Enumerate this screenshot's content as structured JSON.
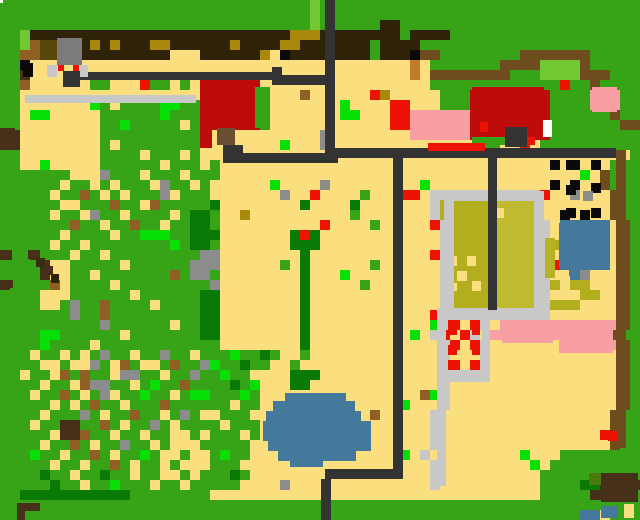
{
  "map": {
    "width": 640,
    "height": 520,
    "tile_size": 10,
    "palette": {
      "G": "#36a416",
      "g": "#07e007",
      "d": "#0a7a07",
      "w": "#72c832",
      "Y": "#fbdf7e",
      "B": "#2e2306",
      "h": "#a8890b",
      "m": "#574708",
      "b": "#8f5f23",
      "u": "#46301a",
      "n": "#6f4c1d",
      "C": "#c07c2a",
      "R": "#ee1205",
      "r": "#be0c0a",
      "K": "#f79fa2",
      "W": "#ffffff",
      "L": "#c8c8c8",
      "A": "#8c8c8c",
      "D": "#333333",
      "k": "#0a0a0a",
      "U": "#45799b",
      "O": "#b2ae1e",
      "o": "#c0ba30"
    },
    "palette_names": {
      "G": "grass",
      "g": "bright-bush",
      "d": "dark-tree",
      "w": "light-grass",
      "Y": "sand",
      "B": "dark-soil",
      "h": "soil-accent",
      "m": "olive-soil",
      "b": "dirt",
      "u": "dark-wood",
      "n": "brown-fence",
      "C": "orange-crate",
      "R": "red-marker",
      "r": "red-roof",
      "K": "pink-blossom",
      "W": "white",
      "L": "gray-road",
      "A": "gray-rock",
      "D": "dark-path",
      "k": "black-hole",
      "U": "water",
      "O": "crop-field",
      "o": "crop-field-light"
    },
    "grid": [
      "GGGGGGGGGGGGGGGGGGGGGGGGGGGGGGGwGGGGGGGGGGGGGGGGGGGGGGGGGGGGGGGG",
      "GGGGGGGGGGGGGGGGGGGGGGGGGGGGGGGwGGGGGGGGGGGGGGGGGGGGGGGGGGGGGGGG",
      "GGGGGGGGGGGGGGGGGGGGGGGGGGGGGGGwGGGGGGBBGGGGGGGGGGGGGGGGGGGGGGGG",
      "GGwBBBBBBBBBBBBBBBBBBBBBBBBBBhhhBBBBBBBBGBBBBGGGGGGGGGGGGGGGGGGGG",
      "GGwbmmBBBhBhBBBhhBBBBBBhBBBBhhBBBBBBBGBBBBGGGGGGGGGGGGGGGGGGGGGG",
      "GGbbmmBBBBBBBBBBBYYYBBBBBBhYkBBBBBBBBGBBBknnGGGGGGGGnnnnnnnGGGGG",
      "GGkYYYYYYYYYYYYYYYYYYYYYYYYYYYYYYYYYYYYYYCYGGGGGGGnnnnwwwwnGGGG",
      "GGuYYYYYYYYYYYYYYYYYYYYYYYYYYYYYYYYYYYYYYCYnnnnnnnnGGGwwwwnnnGG",
      "GGbYYYYYYGGYYYRGGYGYrrrrrrYYYYYYYYYYYYYYYYYGGGGGGGGGGGGGRGGnGG",
      "GGYYYYYYYYYYYYYYYYYYrrrrrrGYYYbYYYYYYRhYYYYYGGGrrrrrrrrGGGGKKKGG",
      "GGYYYYYYYgGYGGGGggGGrrrrrrGYYYYYYYgYYYYRRYYYGGGrrrrrrrrGGGGKKKGG",
      "GGYggYYYYYGGGGGGgGGGrrrrrrGYYYYYYYggYYYRRKKKKKKrrrrrrrrGGGGGGnGG",
      "GGYYYYYYYYGGgGGGGGYGrrrrrrGYYYYYYYYYYYYRRKKKKKKrrrrrrrrGGGGGGGnn",
      "uuYYYYYYYYGGGGGGGGGGYYYYYYYYYYYYAYYYYYYYYKKKKKKrrrrYYrrGGGGGGGGG",
      "uuYYYYYYYYGYGGGGGGGGYYYYYYYYgYYYAYYYYYYYYYYYYYYYGGYYRYGGGGGGGGG",
      "GGYYYYYYYYGGGGYGGGYGYYYYYYYYYYYYYYYYYYYYYYYYYYYYYYYYYYYYYYYYYYY",
      "GGYYgYYYYYGGGGGGYGGGYGYYYYYYYYYYYYYYYYYYYYYYYYYYYYYYYYYkYkYYYG",
      "GGGGGGGYYYAGGGYGGGYGGGYYYYYYYYYYYYYYYYYYYYYYYYYYYYYYYYYYYYgYnG",
      "GGGGGGYGGYGYGGGYAGGYGYYYYYYgYYYYAYYYYYYYYYgYYYYYYYYYYYYkYkYYnG",
      "GGGGGYGGbGYGYGGGAYGGGYYYYYYYAYYRYYYYGYYYRRYLLLLLLLLLLLRYYAYYYnG",
      "GGGGGGYYGGGbGGYbGGGGGdYYYYYYYYdYYYYdYYYYYYYLOOOOYooooLYYYYYYYnG",
      "GGGGGYGGYAGGYGGGGYGddGYYhYYYYYYYYYYGYYYYYYYLOOOOYYoooLYYkYkYYnG",
      "GGGGGGGbGGYGGbGGYGGddGYYYYYYYYYYRYYYYGYYYYYRLOOOOYooooLYUUUUUYnG",
      "GGGGGGYGGGGYGGgggGGdddYYYYYYYdRdYYYYYYYYYYYYLOOOOYooooLYUUUUUYnG",
      "GGGGGYGGYGGGGGGGGgGddGYYYYYYYdddYYYYYYYYYYYYLOOOOYooooLOUUUUUYnG",
      "uGGuGGGYGGYGGGGGGGGGAAYYYYYYYYdYYYYYYYYYYYYRLOOOOYooooLYUUUUUYnG",
      "GGGGuYYGGGGGYGGGGGGAAAYYYYYYGYdYYYYYYGYYYYYYLYOYOYooooLRUUUUUYnG",
      "GGGGuYYGGYGGGGGGGbGAAGYYYYYYYYdYYYgYYYYYYYYYLOYOOYooooLYYUAYYYnG",
      "uGGGGbYGGGGYGGGGGGGGGAYYYYYYYYdYYYYYGYYYYYYYLYOYOYooooLOYOOYYYnG",
      "GGGGYYYGGGGGGYGGGGGGddYYYYYYYYdYYYYYYYYYYYYYLOYOYYooooLYYYOOYYnG",
      "GGGGYYGAGGbGGGGYGGGGddYYYYYYYYdYYYYYYYYYYYYYLOOYOYooooLOOOYYYYnG",
      "GGGGGGGAGGbGGGGGGGGGddYYYYYYYYdYYYYYYYYYYYYRLLLLLLLLLLLYYYYYYYnG",
      "GGGGGGGGGGAGGGGGGYGGddYYYYYYYYdYYYYYYYYYYYYgLRYRLYKKKKKKKKKKKKnG",
      "GGGGggGGGGGGYGGGGGGGddYYYYYYYYdYYYYYYYYYYgYLRYRLYKKKKKKKKKKKKnG",
      "GGGGgGGGGYGGGGGGGGGGGGYYYYYYYYdYYYYYYYYYYYYYLRYRLYYYYYYYKKKKKKnG",
      "GGGYGGYGYGAGGYGGAGGYGGGgGGdGYYGYYYYYYYYYYYYYLYYYLYYYYYYYYYYYYYnG",
      "GGGGYYGYYAGYbGYYGbGGAgGGdGGYYGYYYYYYYYYYYYYYLRYRLYYYYYYYYYYYYYnG",
      "GGYGGYbGbGGYAAGGYGGAGGgGGYYYYdddYYYYYYYYYYYYLLLLLYYYYYYYYYYYYYnG",
      "GGGGYGGYbAAGGYGgGGbGGGGdGgYYYddYYYYYYYYYYYYYLYYYYYYYYYYYYYYYYYnG",
      "GGGYGGbGYGAYGGgGGYGggGGGgGYYYYYYYYYYYYYYYYbgLYYYYYYYYYYYYYYYYYnG",
      "GGGGGYGYGbGGYGGGbGGGGGGYGGYYYYYYYYYYYYYYgYYYLYYYYYYYYYYYYYYYYYnG",
      "GGGGYGGGAGYGGbGGYGAGYYGGGYYYYYYYYYYYYbYYYYYLYYYYYYYYYYYYYYYYYnG",
      "GGGYGGuuGGbGYGGAGYGGGGYGGGYYYYYYYYYYYYYYYYYLYYYYYYYYYYYYYYYYYnG",
      "GGGGGYuubGGYGGYGGYYGYGGGYGYYYYYYYYYYYYYYYYYLYYYYYYYYYYYYYYYYRnG",
      "GGGGYGGbGYGGAGGYGYYYGGGGGYYYYYYYYYYYYYYYYYYLYYYYYYYYYYYYYYYYYnG",
      "GGGgGGYGGbGYGGgGYYGYYGgGGYYYYYYYYYYYYYYYgYLYYYYYYYYYgYYYGGGGGG",
      "GGGGGYGGYGGbGYGGYGYYYGGGYYYYYYYYYYYYYYYYYYYLYYYYYYYYYgYGGGGGGGG",
      "GGGGdGGYGGdGGYGGYYGYGGGdGYYYYYYYYYYYYYYYYYYLYYYYYYYYYYGGGGGGGGG",
      "GGGGGdGGYGGgGGGYGGYGGGGGYYYYAYYYYYYYYYYYYYYLYYYYYYYYYYGGGGdduuuu",
      "GGdddddddddddGGGGGGGGYYYYYYYYYYYYYYYYYYYYYYYYYYYYYYYYYGGGGGuuuu",
      "GGGGGGGGGGGGGGGGGGGGGGGGGGGGGGGGGGGGGGGGGGGGGGGGGGGGGGGGGGGGGG",
      "GGGGGGGGGGGGGGGGGGGGGGGGGGGGGGGGGGGGGGGGGGGGGGGGGGGGGGGGGGUUYG"
    ],
    "features": [
      {
        "name": "crop-field-left",
        "x": 454,
        "y": 201,
        "w": 34,
        "h": 107,
        "color": "#b2ae1e"
      },
      {
        "name": "crop-field-right",
        "x": 497,
        "y": 201,
        "w": 37,
        "h": 107,
        "color": "#c0ba30"
      },
      {
        "name": "crop-field-dot-1",
        "x": 494,
        "y": 208,
        "w": 10,
        "h": 10,
        "color": "#fbdf7e"
      },
      {
        "name": "crop-field-dot-2",
        "x": 447,
        "y": 256,
        "w": 10,
        "h": 10,
        "color": "#fbdf7e"
      },
      {
        "name": "crop-field-dot-3",
        "x": 467,
        "y": 256,
        "w": 9,
        "h": 10,
        "color": "#fbdf7e"
      },
      {
        "name": "crop-field-dot-4",
        "x": 457,
        "y": 271,
        "w": 10,
        "h": 10,
        "color": "#fbdf7e"
      },
      {
        "name": "crop-field-dot-5",
        "x": 447,
        "y": 283,
        "w": 10,
        "h": 8,
        "color": "#fbdf7e"
      },
      {
        "name": "crop-field-dot-6",
        "x": 472,
        "y": 281,
        "w": 9,
        "h": 10,
        "color": "#fbdf7e"
      },
      {
        "name": "field-frame-top",
        "x": 444,
        "y": 191,
        "w": 100,
        "h": 10,
        "color": "#c8c8c8"
      },
      {
        "name": "field-frame-left",
        "x": 444,
        "y": 191,
        "w": 10,
        "h": 127,
        "color": "#c8c8c8"
      },
      {
        "name": "field-frame-right",
        "x": 534,
        "y": 191,
        "w": 10,
        "h": 127,
        "color": "#c8c8c8"
      },
      {
        "name": "field-frame-bottom",
        "x": 444,
        "y": 308,
        "w": 100,
        "h": 10,
        "color": "#c8c8c8"
      },
      {
        "name": "olive-strip-east",
        "x": 545,
        "y": 238,
        "w": 10,
        "h": 40,
        "color": "#b7b224"
      },
      {
        "name": "road-gray",
        "x": 25,
        "y": 95,
        "w": 171,
        "h": 8,
        "color": "#c8c8c8"
      },
      {
        "name": "fence-dark-long",
        "x": 80,
        "y": 72,
        "w": 193,
        "h": 8,
        "color": "#333333"
      },
      {
        "name": "fence-dark-corner",
        "x": 272,
        "y": 67,
        "w": 10,
        "h": 18,
        "color": "#333333"
      },
      {
        "name": "fence-dark-connector",
        "x": 282,
        "y": 75,
        "w": 46,
        "h": 10,
        "color": "#333333"
      },
      {
        "name": "path-vertical-main",
        "x": 325,
        "y": 0,
        "w": 10,
        "h": 153,
        "color": "#333333"
      },
      {
        "name": "path-horizontal-right",
        "x": 335,
        "y": 148,
        "w": 281,
        "h": 10,
        "color": "#333333"
      },
      {
        "name": "path-horizontal-left",
        "x": 223,
        "y": 153,
        "w": 115,
        "h": 10,
        "color": "#333333"
      },
      {
        "name": "path-vertical-mid",
        "x": 393,
        "y": 153,
        "w": 10,
        "h": 326,
        "color": "#333333"
      },
      {
        "name": "path-horizontal-bottom",
        "x": 325,
        "y": 469,
        "w": 78,
        "h": 10,
        "color": "#333333"
      },
      {
        "name": "path-bottom-stub",
        "x": 321,
        "y": 479,
        "w": 10,
        "h": 41,
        "color": "#333333"
      },
      {
        "name": "path-vertical-field",
        "x": 488,
        "y": 158,
        "w": 9,
        "h": 152,
        "color": "#333333"
      },
      {
        "name": "house-red-west",
        "x": 200,
        "y": 82,
        "w": 55,
        "h": 46,
        "color": "#be0c0a"
      },
      {
        "name": "house-west-wing",
        "x": 200,
        "y": 128,
        "w": 12,
        "h": 20,
        "color": "#be0c0a"
      },
      {
        "name": "house-west-lawn",
        "x": 255,
        "y": 87,
        "w": 15,
        "h": 41,
        "color": "#36a416"
      },
      {
        "name": "house-west-door",
        "x": 217,
        "y": 128,
        "w": 18,
        "h": 17,
        "color": "#6b4f32"
      },
      {
        "name": "house-west-step",
        "x": 223,
        "y": 145,
        "w": 20,
        "h": 13,
        "color": "#333333"
      },
      {
        "name": "house-red-east",
        "x": 472,
        "y": 87,
        "w": 72,
        "h": 50,
        "color": "#be0c0a"
      },
      {
        "name": "house-east-door-white",
        "x": 543,
        "y": 120,
        "w": 9,
        "h": 17,
        "color": "#ffffff"
      },
      {
        "name": "house-east-porch",
        "x": 505,
        "y": 127,
        "w": 22,
        "h": 20,
        "color": "#333333"
      },
      {
        "name": "house-east-red-dot-a",
        "x": 480,
        "y": 122,
        "w": 8,
        "h": 10,
        "color": "#ee1205"
      },
      {
        "name": "house-east-red-dot-b",
        "x": 527,
        "y": 137,
        "w": 8,
        "h": 8,
        "color": "#ee1205"
      },
      {
        "name": "house-east-lawn",
        "x": 472,
        "y": 137,
        "w": 33,
        "h": 8,
        "color": "#36a416"
      },
      {
        "name": "red-bar",
        "x": 428,
        "y": 143,
        "w": 57,
        "h": 8,
        "color": "#ee1205"
      },
      {
        "name": "pink-patch-west",
        "x": 415,
        "y": 113,
        "w": 55,
        "h": 25,
        "color": "#f79fa2"
      },
      {
        "name": "pink-patch-northeast",
        "x": 592,
        "y": 87,
        "w": 25,
        "h": 25,
        "color": "#f79fa2"
      },
      {
        "name": "pink-patch-south-a",
        "x": 502,
        "y": 320,
        "w": 51,
        "h": 23,
        "color": "#f79fa2"
      },
      {
        "name": "pink-patch-south-b",
        "x": 559,
        "y": 321,
        "w": 54,
        "h": 32,
        "color": "#f79fa2"
      },
      {
        "name": "statue-body",
        "x": 57,
        "y": 38,
        "w": 25,
        "h": 27,
        "color": "#7b7b7b"
      },
      {
        "name": "statue-side-left",
        "x": 47,
        "y": 65,
        "w": 10,
        "h": 12,
        "color": "#c8c8c8"
      },
      {
        "name": "statue-side-right",
        "x": 80,
        "y": 65,
        "w": 8,
        "h": 12,
        "color": "#c8c8c8"
      },
      {
        "name": "statue-base",
        "x": 63,
        "y": 71,
        "w": 17,
        "h": 16,
        "color": "#333333"
      },
      {
        "name": "statue-eye-left",
        "x": 58,
        "y": 65,
        "w": 6,
        "h": 6,
        "color": "#ee1205"
      },
      {
        "name": "statue-eye-right",
        "x": 73,
        "y": 65,
        "w": 6,
        "h": 6,
        "color": "#ee1205"
      },
      {
        "name": "rock-black",
        "x": 23,
        "y": 63,
        "w": 10,
        "h": 14,
        "color": "#0a0a0a"
      },
      {
        "name": "pond-small-main",
        "x": 559,
        "y": 223,
        "w": 38,
        "h": 45,
        "color": "#45799b"
      },
      {
        "name": "pond-small-east",
        "x": 597,
        "y": 233,
        "w": 10,
        "h": 30,
        "color": "#45799b"
      },
      {
        "name": "pond-small-notch",
        "x": 569,
        "y": 268,
        "w": 10,
        "h": 8,
        "color": "#45799b"
      },
      {
        "name": "pond-large-1",
        "x": 285,
        "y": 393,
        "w": 61,
        "h": 8,
        "color": "#45799b"
      },
      {
        "name": "pond-large-2",
        "x": 273,
        "y": 401,
        "w": 82,
        "h": 10,
        "color": "#45799b"
      },
      {
        "name": "pond-large-3",
        "x": 266,
        "y": 411,
        "w": 95,
        "h": 10,
        "color": "#45799b"
      },
      {
        "name": "pond-large-4",
        "x": 263,
        "y": 421,
        "w": 108,
        "h": 20,
        "color": "#45799b"
      },
      {
        "name": "pond-large-5",
        "x": 268,
        "y": 441,
        "w": 103,
        "h": 10,
        "color": "#45799b"
      },
      {
        "name": "pond-large-6",
        "x": 278,
        "y": 451,
        "w": 78,
        "h": 10,
        "color": "#45799b"
      },
      {
        "name": "pond-large-7",
        "x": 290,
        "y": 461,
        "w": 33,
        "h": 6,
        "color": "#45799b"
      },
      {
        "name": "pen-rail-west",
        "x": 437,
        "y": 308,
        "w": 9,
        "h": 178,
        "color": "#c8c8c8"
      },
      {
        "name": "pen-rail-east",
        "x": 482,
        "y": 318,
        "w": 8,
        "h": 64,
        "color": "#c8c8c8"
      },
      {
        "name": "pen-rail-south",
        "x": 446,
        "y": 372,
        "w": 36,
        "h": 10,
        "color": "#c8c8c8"
      },
      {
        "name": "pen-red-dot-1",
        "x": 448,
        "y": 320,
        "w": 9,
        "h": 15,
        "color": "#ee1205"
      },
      {
        "name": "pen-red-dot-2",
        "x": 472,
        "y": 320,
        "w": 8,
        "h": 15,
        "color": "#ee1205"
      },
      {
        "name": "pen-red-dot-3",
        "x": 448,
        "y": 345,
        "w": 9,
        "h": 10,
        "color": "#ee1205"
      },
      {
        "name": "pen-red-dot-4",
        "x": 472,
        "y": 345,
        "w": 8,
        "h": 10,
        "color": "#ee1205"
      },
      {
        "name": "pen-red-dot-5",
        "x": 448,
        "y": 360,
        "w": 9,
        "h": 10,
        "color": "#ee1205"
      },
      {
        "name": "pen-red-dot-6",
        "x": 472,
        "y": 360,
        "w": 8,
        "h": 10,
        "color": "#ee1205"
      },
      {
        "name": "orchard-hole-1",
        "x": 566,
        "y": 160,
        "w": 10,
        "h": 10,
        "color": "#0a0a0a"
      },
      {
        "name": "orchard-hole-2",
        "x": 591,
        "y": 160,
        "w": 10,
        "h": 10,
        "color": "#0a0a0a"
      },
      {
        "name": "orchard-hole-3",
        "x": 566,
        "y": 185,
        "w": 10,
        "h": 10,
        "color": "#0a0a0a"
      },
      {
        "name": "orchard-hole-4",
        "x": 591,
        "y": 183,
        "w": 10,
        "h": 10,
        "color": "#0a0a0a"
      },
      {
        "name": "orchard-hole-5",
        "x": 566,
        "y": 208,
        "w": 10,
        "h": 10,
        "color": "#0a0a0a"
      },
      {
        "name": "orchard-hole-6",
        "x": 591,
        "y": 208,
        "w": 10,
        "h": 10,
        "color": "#0a0a0a"
      },
      {
        "name": "orchard-rock",
        "x": 583,
        "y": 191,
        "w": 10,
        "h": 10,
        "color": "#8c8c8c"
      },
      {
        "name": "fence-column-east",
        "x": 616,
        "y": 150,
        "w": 10,
        "h": 298,
        "color": "#6f4c1d"
      },
      {
        "name": "fence-column-red",
        "x": 608,
        "y": 431,
        "w": 10,
        "h": 10,
        "color": "#ee1205"
      },
      {
        "name": "shed-brown",
        "x": 601,
        "y": 473,
        "w": 37,
        "h": 29,
        "color": "#46301a"
      },
      {
        "name": "shed-moss",
        "x": 589,
        "y": 473,
        "w": 12,
        "h": 12,
        "color": "#4a7a10"
      },
      {
        "name": "shed-water",
        "x": 601,
        "y": 506,
        "w": 17,
        "h": 12,
        "color": "#45799b"
      },
      {
        "name": "shed-sand",
        "x": 624,
        "y": 504,
        "w": 10,
        "h": 14,
        "color": "#fbdf7e"
      },
      {
        "name": "flag-top",
        "x": 17,
        "y": 503,
        "w": 23,
        "h": 8,
        "color": "#46301a"
      },
      {
        "name": "flag-pole",
        "x": 17,
        "y": 511,
        "w": 8,
        "h": 9,
        "color": "#46301a"
      },
      {
        "name": "cliff-block-a",
        "x": 0,
        "y": 128,
        "w": 15,
        "h": 22,
        "color": "#46301a"
      },
      {
        "name": "cliff-block-b",
        "x": 0,
        "y": 250,
        "w": 12,
        "h": 10,
        "color": "#46301a"
      },
      {
        "name": "cliff-block-c",
        "x": 0,
        "y": 280,
        "w": 13,
        "h": 8,
        "color": "#46301a"
      },
      {
        "name": "log-a",
        "x": 28,
        "y": 250,
        "w": 9,
        "h": 9,
        "color": "#46301a"
      },
      {
        "name": "log-b",
        "x": 36,
        "y": 258,
        "w": 9,
        "h": 9,
        "color": "#3a2a10"
      },
      {
        "name": "log-c",
        "x": 44,
        "y": 266,
        "w": 9,
        "h": 9,
        "color": "#46301a"
      },
      {
        "name": "log-d",
        "x": 51,
        "y": 274,
        "w": 8,
        "h": 9,
        "color": "#2e2306"
      },
      {
        "name": "white-marker",
        "x": 0,
        "y": 0,
        "w": 3,
        "h": 3,
        "color": "#ffffff"
      }
    ]
  }
}
